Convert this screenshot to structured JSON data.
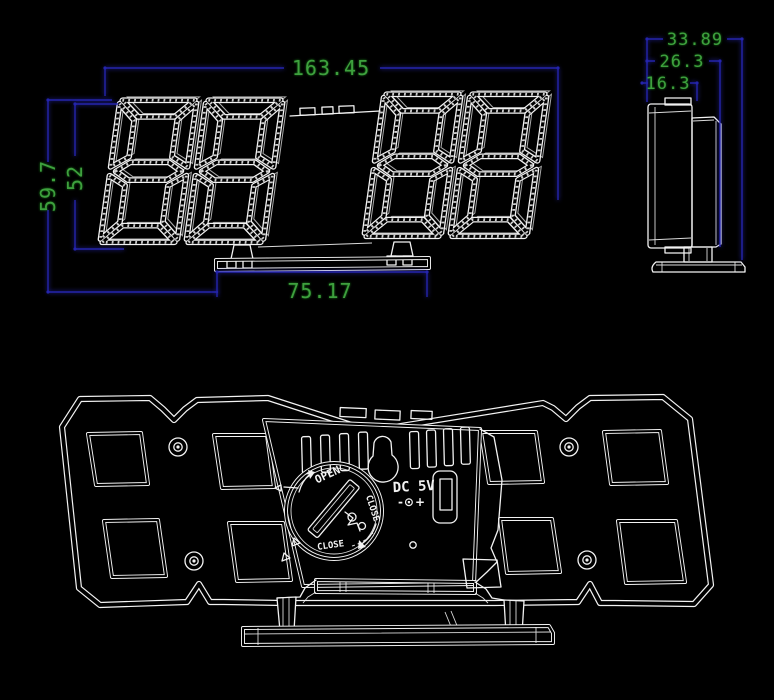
{
  "colors": {
    "background": "#000000",
    "line": "#f2f2f2",
    "dimension_line": "#2424ac",
    "dimension_text": "#3ea03e"
  },
  "front_view": {
    "width_label": "163.45",
    "total_height_label": "59.7",
    "display_height_label": "52",
    "base_width_label": "75.17"
  },
  "side_view": {
    "total_depth_label": "33.89",
    "body_depth_label": "26.3",
    "front_depth_label": "16.3"
  },
  "back_view": {
    "power_port_label": "DC 5V",
    "polarity_label": "-⊙+",
    "battery_cover_open_label": "OPEN",
    "battery_cover_close_label": "CLOSE",
    "battery_cover_close_bottom_label": "CLOSE"
  }
}
